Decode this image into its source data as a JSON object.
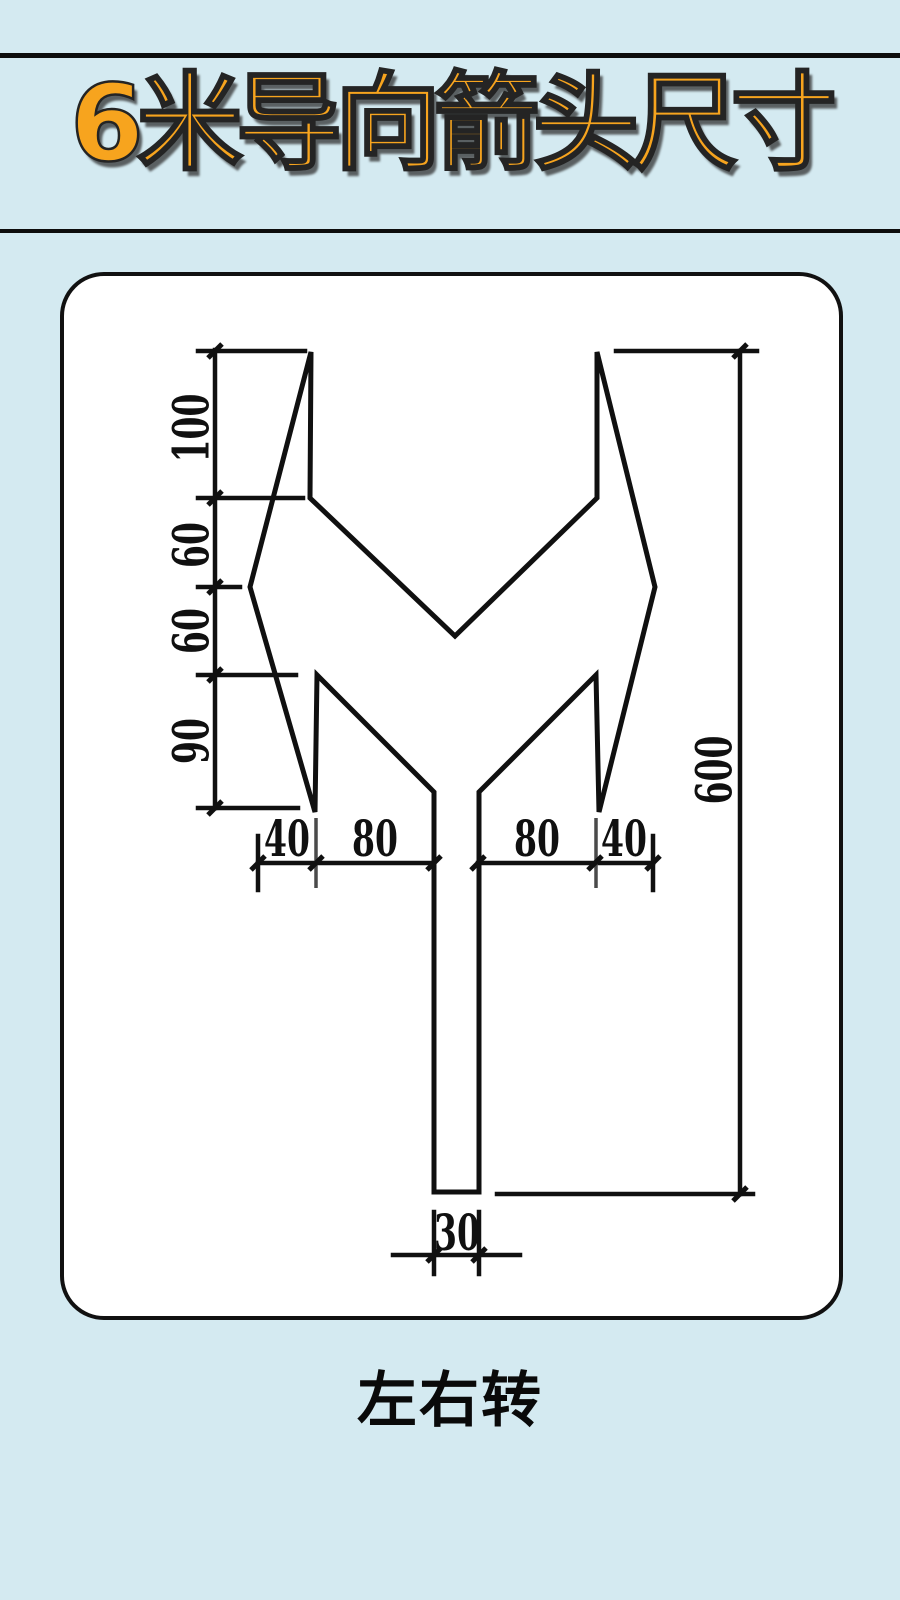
{
  "header": {
    "title": "6米导向箭头尺寸"
  },
  "diagram": {
    "caption": "左右转",
    "dims": {
      "left_top": "100",
      "left_upper_mid": "60",
      "left_lower_mid": "60",
      "left_bottom": "90",
      "right_total": "600",
      "bottom_left_outer": "40",
      "bottom_left_inner": "80",
      "bottom_right_inner": "80",
      "bottom_right_outer": "40",
      "stem_width": "30"
    }
  },
  "colors": {
    "background": "#d4eaf1",
    "title_fill": "#f7a41e",
    "ink": "#111111",
    "card_background": "#ffffff"
  }
}
